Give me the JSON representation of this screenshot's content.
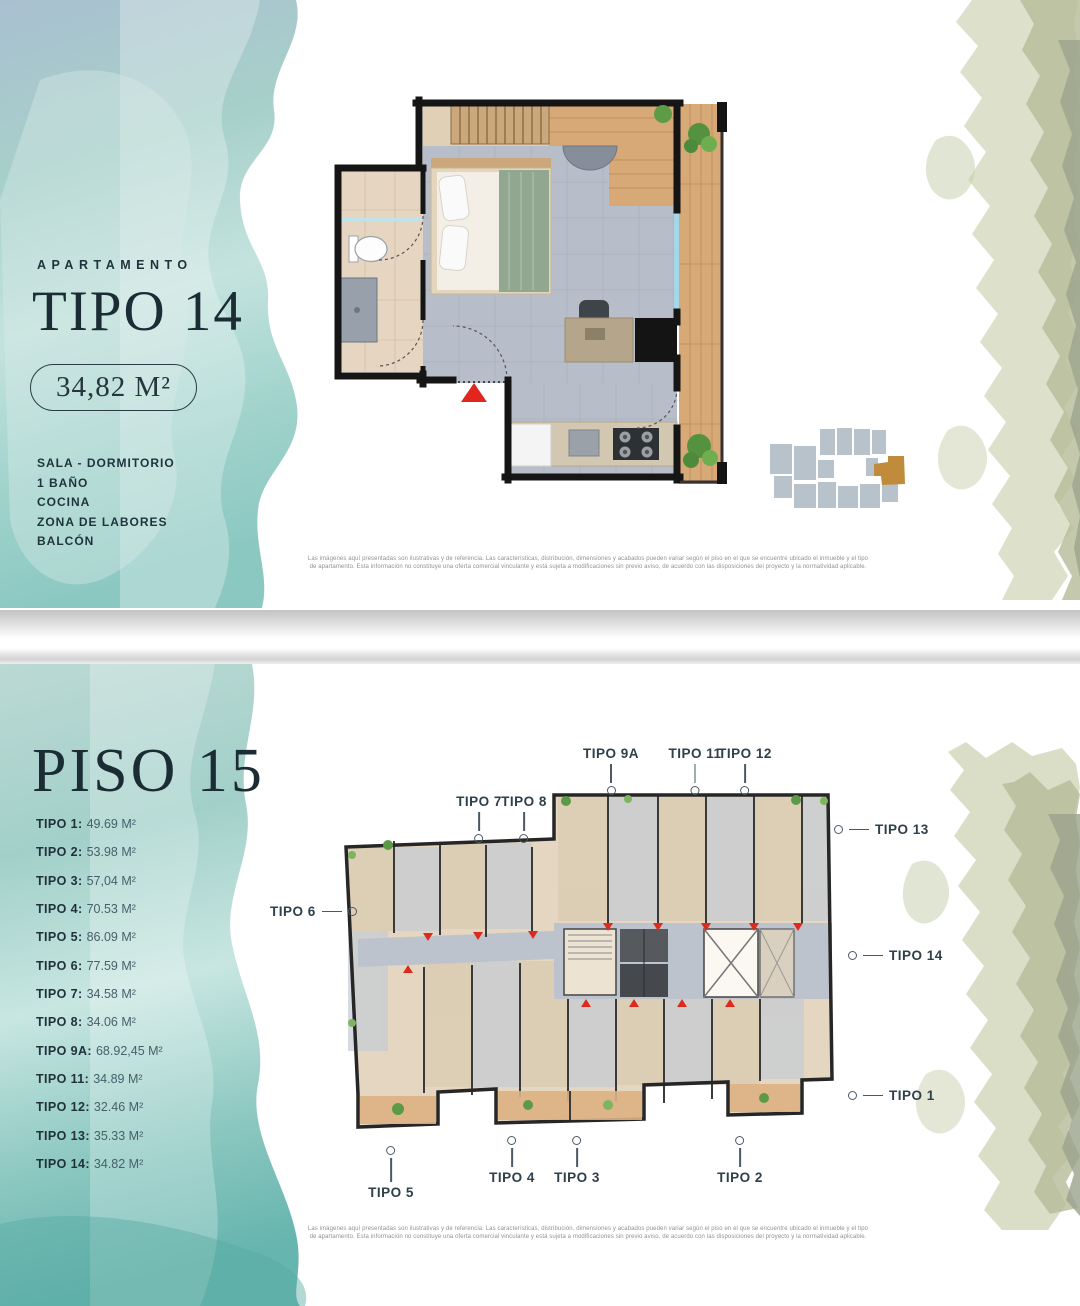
{
  "top_panel": {
    "eyebrow": "APARTAMENTO",
    "title": "TIPO 14",
    "area_badge": "34,82 M²",
    "features": [
      "SALA - DORMITORIO",
      "1 BAÑO",
      "COCINA",
      "ZONA DE LABORES",
      "BALCÓN"
    ],
    "disclaimer": "Las imágenes aquí presentadas son ilustrativas y de referencia. Las características, distribución, dimensiones y acabados pueden variar según el piso en el que se encuentre ubicado el inmueble y el tipo de apartamento. Esta información no constituye una oferta comercial vinculante y está sujeta a modificaciones sin previo aviso, de acuerdo con las disposiciones del proyecto y la normatividad aplicable."
  },
  "bottom_panel": {
    "title": "PISO 15",
    "unit_list": [
      {
        "label": "TIPO 1:",
        "value": "49.69 M²"
      },
      {
        "label": "TIPO 2:",
        "value": "53.98 M²"
      },
      {
        "label": "TIPO 3:",
        "value": "57,04 M²"
      },
      {
        "label": "TIPO 4:",
        "value": "70.53 M²"
      },
      {
        "label": "TIPO 5:",
        "value": "86.09 M²"
      },
      {
        "label": "TIPO 6:",
        "value": "77.59 M²"
      },
      {
        "label": "TIPO 7:",
        "value": "34.58 M²"
      },
      {
        "label": "TIPO 8:",
        "value": "34.06 M²"
      },
      {
        "label": "TIPO 9A:",
        "value": "68.92,45 M²"
      },
      {
        "label": "TIPO 11:",
        "value": "34.89 M²"
      },
      {
        "label": "TIPO 12:",
        "value": "32.46 M²"
      },
      {
        "label": "TIPO 13:",
        "value": "35.33 M²"
      },
      {
        "label": "TIPO 14:",
        "value": "34.82 M²"
      }
    ],
    "plan_labels": {
      "tipo9a": "TIPO 9A",
      "tipo11": "TIPO 11",
      "tipo12": "TIPO 12",
      "tipo7": "TIPO 7",
      "tipo8": "TIPO 8",
      "tipo13": "TIPO 13",
      "tipo14": "TIPO 14",
      "tipo1": "TIPO 1",
      "tipo6": "TIPO 6",
      "tipo5": "TIPO 5",
      "tipo4": "TIPO 4",
      "tipo3": "TIPO 3",
      "tipo2": "TIPO 2"
    },
    "disclaimer": "Las imágenes aquí presentadas son ilustrativas y de referencia. Las características, distribución, dimensiones y acabados pueden variar según el piso en el que se encuentre ubicado el inmueble y el tipo de apartamento. Esta información no constituye una oferta comercial vinculante y está sujeta a modificaciones sin previo aviso, de acuerdo con las disposiciones del proyecto y la normatividad aplicable."
  },
  "colors": {
    "teal_watercolor": "#9ed0ca",
    "olive_watercolor": "#b5bb98",
    "entrance_red": "#e0261d",
    "locator_highlight": "#c08c3c",
    "title_ink": "#1b2c34",
    "plan_wall": "#151515",
    "plan_tile": "#b8bec9",
    "plan_wood": "#d7a977"
  }
}
